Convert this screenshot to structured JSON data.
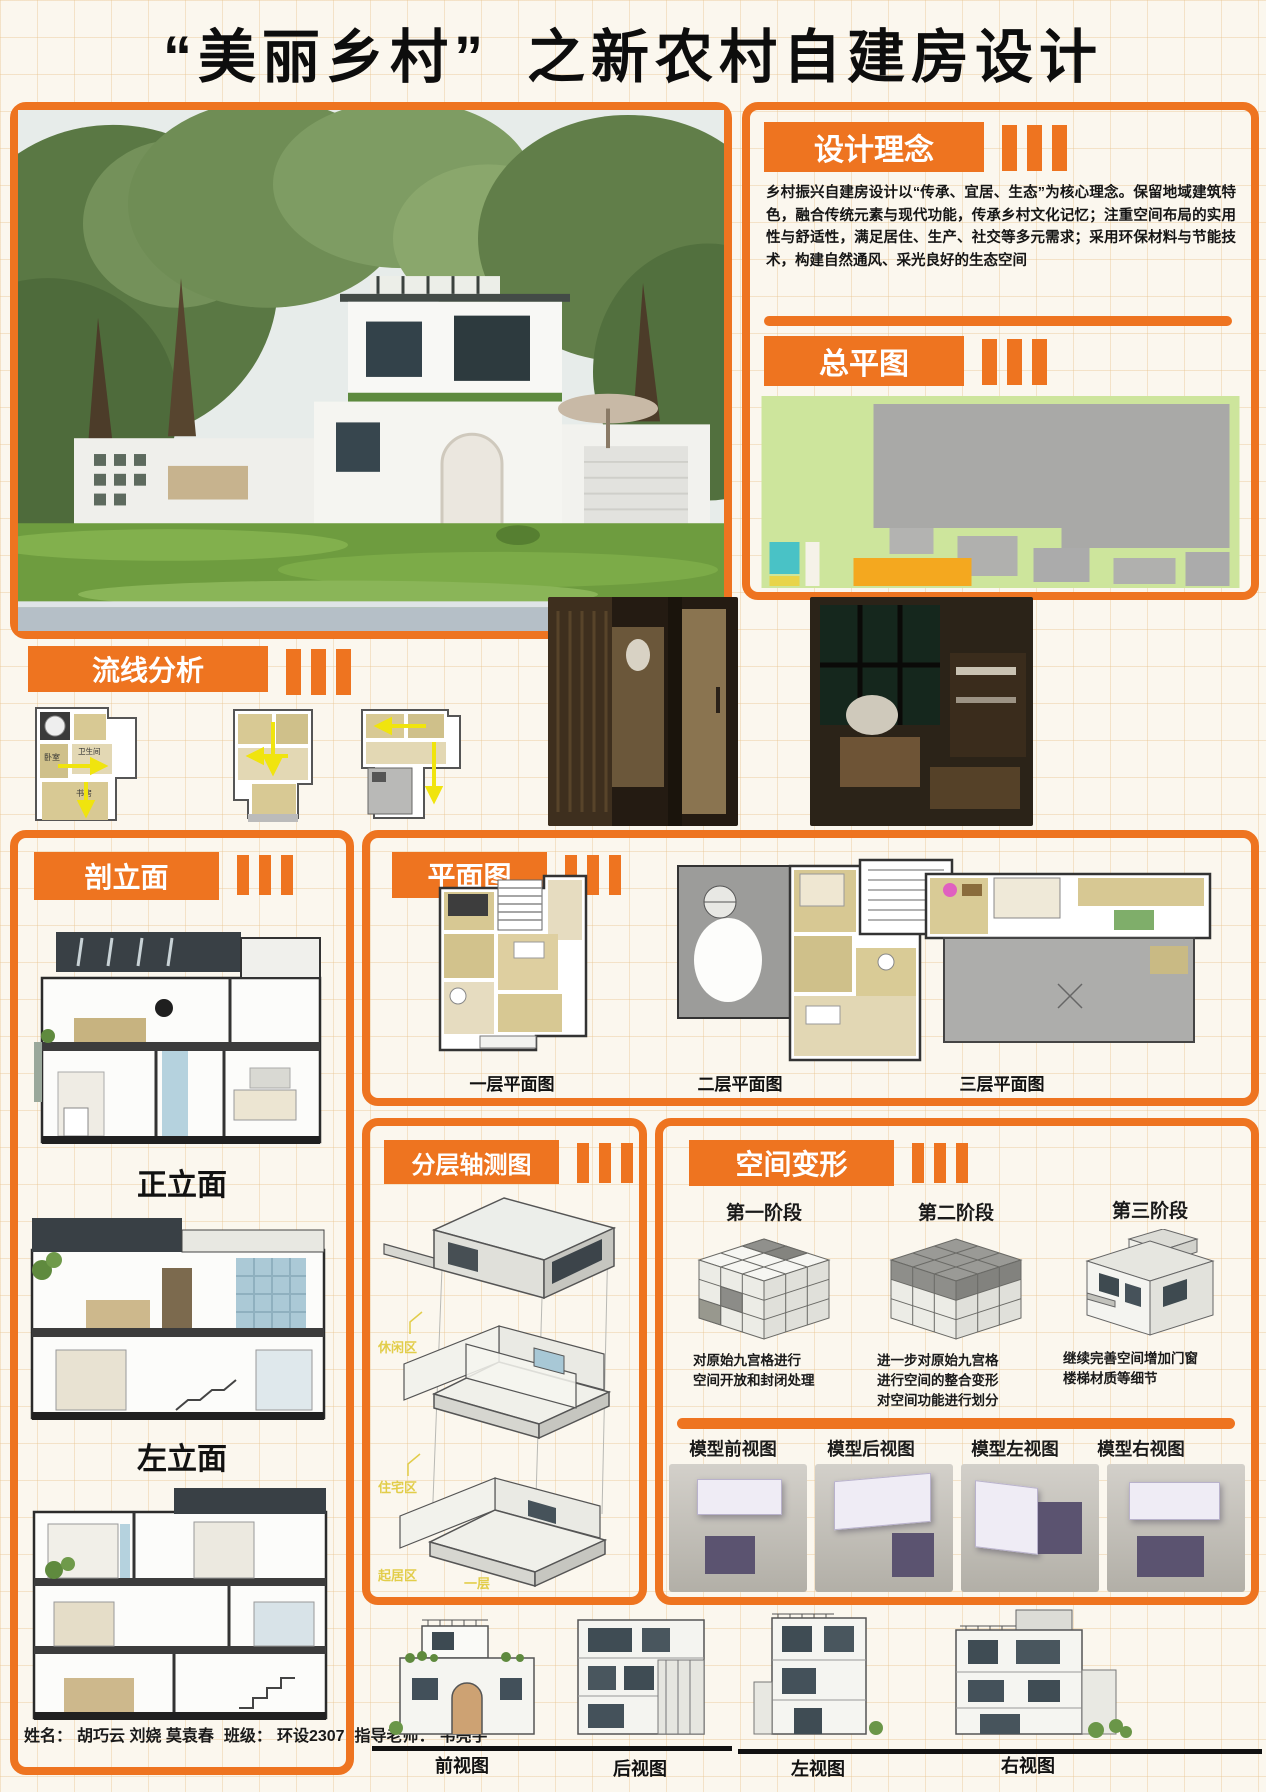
{
  "title": {
    "part1": "“美丽乡村”",
    "part2": "之新农村自建房设计"
  },
  "design_concept": {
    "heading": "设计理念",
    "body": "乡村振兴自建房设计以“传承、宜居、生态”为核心理念。保留地域建筑特色，融合传统元素与现代功能，传承乡村文化记忆；注重空间布局的实用性与舒适性，满足居住、生产、社交等多元需求；采用环保材料与节能技术，构建自然通风、采光良好的生态空间"
  },
  "master_plan": {
    "heading": "总平图"
  },
  "circulation": {
    "heading": "流线分析",
    "room_labels": [
      "卧室",
      "卫生间",
      "书房"
    ]
  },
  "section_panel": {
    "heading": "剖立面",
    "label_front": "正立面",
    "label_left": "左立面"
  },
  "plan_panel": {
    "heading": "平面图",
    "labels": [
      "一层平面图",
      "二层平面图",
      "三层平面图"
    ]
  },
  "axon_panel": {
    "heading": "分层轴测图",
    "floors": [
      {
        "zone": "休闲区",
        "level": "三层"
      },
      {
        "zone": "住宅区",
        "level": "二层"
      },
      {
        "zone": "起居区",
        "level": "一层"
      }
    ]
  },
  "transform_panel": {
    "heading": "空间变形",
    "stages": [
      {
        "title": "第一阶段",
        "desc": "对原始九宫格进行\n空间开放和封闭处理"
      },
      {
        "title": "第二阶段",
        "desc": "进一步对原始九宫格\n进行空间的整合变形\n对空间功能进行划分"
      },
      {
        "title": "第三阶段",
        "desc": "继续完善空间增加门窗\n楼梯材质等细节"
      }
    ],
    "model_views": [
      "模型前视图",
      "模型后视图",
      "模型左视图",
      "模型右视图"
    ]
  },
  "bottom_elevations": {
    "labels": [
      "前视图",
      "后视图",
      "左视图",
      "右视图"
    ]
  },
  "credits": {
    "name_label": "姓名：",
    "names": "胡巧云 刘娆 莫袁春",
    "class_label": "班级：",
    "class_value": "环设2307",
    "teacher_label": "指导老师：",
    "teacher_value": "韦亮宇"
  },
  "colors": {
    "accent": "#ee7420",
    "site_green": "#cde59c",
    "plan_tan": "#d8c994",
    "axon_label_yellow": "#e2cd4a"
  }
}
